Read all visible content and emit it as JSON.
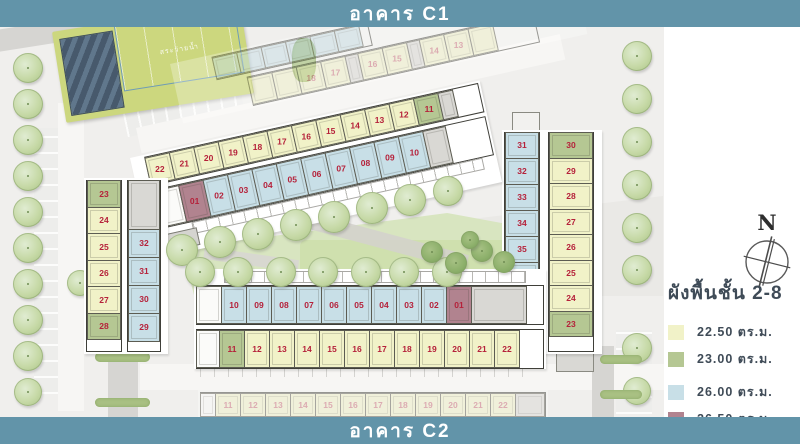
{
  "banners": {
    "top": "อาคาร C1",
    "bottom": "อาคาร C2"
  },
  "compass": {
    "label": "N"
  },
  "pool": {
    "label": "สระว่ายน้ำ"
  },
  "legend": {
    "title": "ผังพื้นชั้น 2-8",
    "items": [
      {
        "label": "22.50 ตร.ม.",
        "color": "#f1f2c8"
      },
      {
        "label": "23.00 ตร.ม.",
        "color": "#b5c793"
      },
      {
        "label": "26.00 ตร.ม.",
        "color": "#c8dfe7"
      },
      {
        "label": "26.50 ตร.ม.",
        "color": "#b1838f"
      }
    ]
  },
  "colors": {
    "banner": "#6294a9",
    "unit_yellow": "#f1f2c8",
    "unit_green": "#b5c793",
    "unit_blue": "#c8dfe7",
    "unit_red": "#b1838f",
    "unit_number": "#b5213a",
    "legend_ink": "#3f4b57"
  },
  "buildings": {
    "c1": {
      "bar_upper": [
        {
          "n": "22",
          "t": "y"
        },
        {
          "n": "21",
          "t": "y"
        },
        {
          "n": "20",
          "t": "y"
        },
        {
          "n": "19",
          "t": "y"
        },
        {
          "n": "18",
          "t": "y"
        },
        {
          "n": "17",
          "t": "y"
        },
        {
          "n": "16",
          "t": "y"
        },
        {
          "n": "15",
          "t": "y"
        },
        {
          "n": "14",
          "t": "y"
        },
        {
          "n": "13",
          "t": "y"
        },
        {
          "n": "12",
          "t": "y"
        },
        {
          "n": "11",
          "t": "g"
        },
        {
          "t": "s",
          "w": 16
        }
      ],
      "bar_lower": [
        {
          "t": "w",
          "w": 40
        },
        {
          "n": "01",
          "t": "r"
        },
        {
          "n": "02",
          "t": "b"
        },
        {
          "n": "03",
          "t": "b"
        },
        {
          "n": "04",
          "t": "b"
        },
        {
          "n": "05",
          "t": "b"
        },
        {
          "n": "06",
          "t": "b"
        },
        {
          "n": "07",
          "t": "b"
        },
        {
          "n": "08",
          "t": "b"
        },
        {
          "n": "09",
          "t": "b"
        },
        {
          "n": "10",
          "t": "b"
        },
        {
          "t": "s",
          "w": 24
        }
      ],
      "wing_west": [
        {
          "n": "23",
          "t": "g"
        },
        {
          "n": "24",
          "t": "y"
        },
        {
          "n": "25",
          "t": "y"
        },
        {
          "n": "26",
          "t": "y"
        },
        {
          "n": "27",
          "t": "y"
        },
        {
          "n": "28",
          "t": "g"
        }
      ],
      "wing_east": [
        {
          "t": "s",
          "h": 50
        },
        {
          "n": "32",
          "t": "b"
        },
        {
          "n": "31",
          "t": "b"
        },
        {
          "n": "30",
          "t": "b"
        },
        {
          "n": "29",
          "t": "b"
        }
      ]
    },
    "c2": {
      "bar_upper": [
        {
          "t": "w",
          "w": 26
        },
        {
          "n": "10",
          "t": "b"
        },
        {
          "n": "09",
          "t": "b"
        },
        {
          "n": "08",
          "t": "b"
        },
        {
          "n": "07",
          "t": "b"
        },
        {
          "n": "06",
          "t": "b"
        },
        {
          "n": "05",
          "t": "b"
        },
        {
          "n": "04",
          "t": "b"
        },
        {
          "n": "03",
          "t": "b"
        },
        {
          "n": "02",
          "t": "b"
        },
        {
          "n": "01",
          "t": "r"
        },
        {
          "t": "s",
          "w": 56
        }
      ],
      "bar_lower": [
        {
          "t": "w",
          "w": 24
        },
        {
          "n": "11",
          "t": "g"
        },
        {
          "n": "12",
          "t": "y"
        },
        {
          "n": "13",
          "t": "y"
        },
        {
          "n": "14",
          "t": "y"
        },
        {
          "n": "15",
          "t": "y"
        },
        {
          "n": "16",
          "t": "y"
        },
        {
          "n": "17",
          "t": "y"
        },
        {
          "n": "18",
          "t": "y"
        },
        {
          "n": "19",
          "t": "y"
        },
        {
          "n": "20",
          "t": "y"
        },
        {
          "n": "21",
          "t": "y"
        },
        {
          "n": "22",
          "t": "y"
        }
      ],
      "wing_west": [
        {
          "n": "31",
          "t": "b"
        },
        {
          "n": "32",
          "t": "b"
        },
        {
          "n": "33",
          "t": "b"
        },
        {
          "n": "34",
          "t": "b"
        },
        {
          "n": "35",
          "t": "b"
        },
        {
          "n": "36",
          "t": "b"
        },
        {
          "t": "s",
          "h": 52
        }
      ],
      "wing_east": [
        {
          "n": "30",
          "t": "g"
        },
        {
          "n": "29",
          "t": "y"
        },
        {
          "n": "28",
          "t": "y"
        },
        {
          "n": "27",
          "t": "y"
        },
        {
          "n": "26",
          "t": "y"
        },
        {
          "n": "25",
          "t": "y"
        },
        {
          "n": "24",
          "t": "y"
        },
        {
          "n": "23",
          "t": "g"
        }
      ]
    },
    "ghost_top": {
      "row_blue": [
        {
          "t": "b"
        },
        {
          "t": "b"
        },
        {
          "t": "b"
        },
        {
          "t": "b"
        },
        {
          "t": "b"
        },
        {
          "t": "b"
        }
      ],
      "row_yellow": [
        {
          "t": "y"
        },
        {
          "t": "y"
        },
        {
          "n": "18",
          "t": "y"
        },
        {
          "n": "17",
          "t": "y"
        },
        {
          "t": "s",
          "w": 14
        },
        {
          "n": "16",
          "t": "y"
        },
        {
          "n": "15",
          "t": "y"
        },
        {
          "t": "s",
          "w": 14
        },
        {
          "n": "14",
          "t": "y"
        },
        {
          "n": "13",
          "t": "y"
        },
        {
          "t": "y"
        }
      ]
    },
    "ghost_bottom": {
      "row": [
        {
          "t": "w",
          "w": 16
        },
        {
          "n": "11",
          "t": "y"
        },
        {
          "n": "12",
          "t": "y"
        },
        {
          "n": "13",
          "t": "y"
        },
        {
          "n": "14",
          "t": "y"
        },
        {
          "n": "15",
          "t": "y"
        },
        {
          "n": "16",
          "t": "y"
        },
        {
          "n": "17",
          "t": "y"
        },
        {
          "n": "18",
          "t": "y"
        },
        {
          "n": "19",
          "t": "y"
        },
        {
          "n": "20",
          "t": "y"
        },
        {
          "n": "21",
          "t": "y"
        },
        {
          "n": "22",
          "t": "y"
        },
        {
          "t": "s",
          "w": 30
        }
      ]
    }
  }
}
